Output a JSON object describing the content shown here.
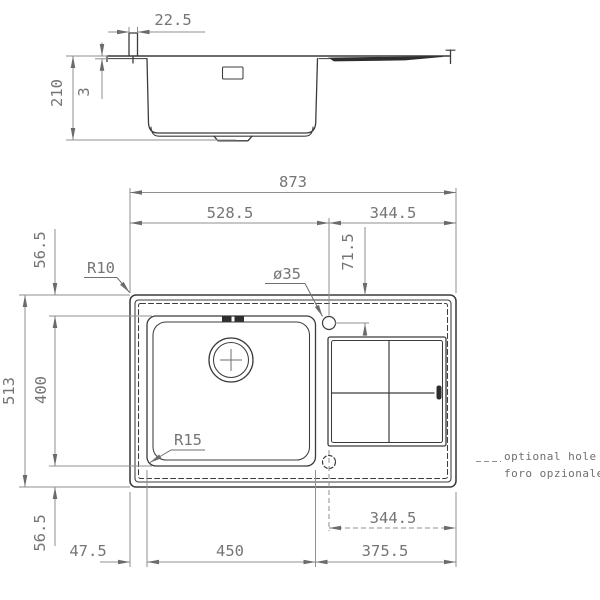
{
  "drawing_title": "sink technical drawing",
  "colors": {
    "line": "#3c3c3c",
    "dimension": "#8f8f8f",
    "text": "#757575",
    "background": "#ffffff"
  },
  "side_view": {
    "dim_edge_width": "22.5",
    "dim_rim_thickness": "3",
    "dim_bowl_depth": "210"
  },
  "plan_view": {
    "dim_total_width": "873",
    "dim_left_section": "528.5",
    "dim_right_section": "344.5",
    "dim_hole_offset": "71.5",
    "dim_hole_diameter": "ø35",
    "radius_outer_corner": "R10",
    "radius_bowl_corner": "R15",
    "dim_total_depth": "513",
    "dim_bowl_front": "400",
    "dim_top_margin": "56.5",
    "dim_bottom_margin": "56.5",
    "dim_left_margin": "47.5",
    "dim_bowl_width": "450",
    "dim_drainer_width": "375.5",
    "dim_optional_hole_offset": "344.5"
  },
  "legend": {
    "optional_hole_en": "optional hole",
    "optional_hole_it": "foro opzionale"
  }
}
